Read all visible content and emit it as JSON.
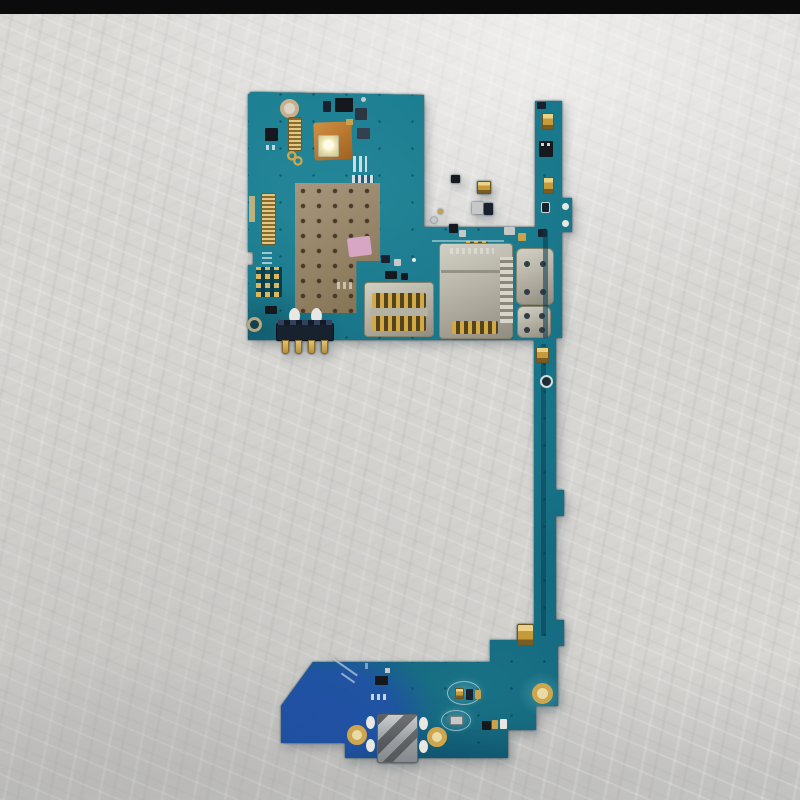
{
  "scene": {
    "description": "Photograph of a bare smartphone motherboard (logic board) with attached charging sub-board, lying on a crinkled light-gray surface",
    "background": "crinkled white-gray plastic sheet",
    "top_edge": "black horizontal bar across top of photo",
    "object": "teal phone PCB: main board (top left), narrow interconnect strip (right), charging-port sub-board (bottom)"
  },
  "palette": {
    "bg_base": "#d7d6d3",
    "top_bar": "#0b0b0b",
    "pcb": "#15758a",
    "pcb_deep": "#083b4c",
    "pcb_blue": "#2252aa",
    "gold": "#c9a24b",
    "silver": "#c7c9c9",
    "metal": "#b3b6b8",
    "navy": "#18222f",
    "ink": "#15191d",
    "white_pad": "#e9e7e2",
    "silk": "#dfe8ea",
    "shield_tan": "#9c8a6e",
    "sticker_pink": "#d7a6c4",
    "copper_flex": "#c07c30",
    "led_white": "#f7f2dc",
    "hole_tan": "#c9b08a"
  },
  "parts": [
    {
      "name": "screw-hole-top-left",
      "kind": "hole",
      "x": 280,
      "y": 99,
      "w": 19,
      "h": 19,
      "border": "4px solid #c9b08a",
      "fill": "#d8d4c8"
    },
    {
      "name": "fpc-connector-top-left",
      "kind": "ridged-h",
      "x": 288,
      "y": 117,
      "w": 14,
      "h": 34,
      "rr": 2,
      "border": "1px solid #6b5a28"
    },
    {
      "name": "ic-chip-a",
      "x": 265,
      "y": 128,
      "w": 13,
      "h": 13,
      "fill": "ink",
      "rr": 1
    },
    {
      "name": "pad-dots-a",
      "kind": "stripes-white",
      "x": 266,
      "y": 145,
      "w": 12,
      "h": 5,
      "op": 0.8
    },
    {
      "name": "antenna-squiggle",
      "kind": "squiggle",
      "x": 286,
      "y": 150,
      "w": 18,
      "h": 16
    },
    {
      "name": "flex-pad-orange",
      "kind": "copper",
      "x": 314,
      "y": 122,
      "w": 38,
      "h": 38,
      "rr": 3,
      "rot": -2
    },
    {
      "name": "led-flash",
      "kind": "led",
      "x": 318,
      "y": 135,
      "w": 21,
      "h": 22
    },
    {
      "name": "ic-chip-b",
      "x": 335,
      "y": 98,
      "w": 18,
      "h": 14,
      "fill": "ink",
      "rr": 1
    },
    {
      "name": "ic-chip-b2",
      "x": 323,
      "y": 101,
      "w": 8,
      "h": 11,
      "fill": "navy",
      "rr": 1
    },
    {
      "name": "ic-chip-c",
      "x": 355,
      "y": 108,
      "w": 12,
      "h": 12,
      "fill": "#2c3540",
      "rr": 1
    },
    {
      "name": "ic-chip-d",
      "x": 357,
      "y": 128,
      "w": 13,
      "h": 11,
      "fill": "#35404e",
      "rr": 1
    },
    {
      "name": "dot-silver-a",
      "kind": "dot",
      "x": 361,
      "y": 97,
      "w": 5,
      "h": 5,
      "fill": "silver"
    },
    {
      "name": "chip-gold-tiny-a",
      "x": 346,
      "y": 119,
      "w": 7,
      "h": 6,
      "fill": "gold"
    },
    {
      "name": "pad-row-a",
      "kind": "stripes-white",
      "x": 353,
      "y": 156,
      "w": 14,
      "h": 16,
      "op": 0.85
    },
    {
      "name": "pad-row-b",
      "kind": "stripes-blue",
      "x": 352,
      "y": 175,
      "w": 22,
      "h": 8
    },
    {
      "name": "pad-row-c",
      "kind": "stripes-white",
      "x": 344,
      "y": 186,
      "w": 18,
      "h": 6,
      "op": 0.7
    },
    {
      "name": "edge-pad-gold",
      "x": 249,
      "y": 196,
      "w": 6,
      "h": 26,
      "fill": "#cdb77c",
      "op": 0.9
    },
    {
      "name": "fpc-connector-left",
      "kind": "ridged-h",
      "x": 261,
      "y": 193,
      "w": 15,
      "h": 52,
      "rr": 2,
      "border": "1px solid #6b5a28"
    },
    {
      "name": "silk-dashes-a",
      "kind": "stripes-white-h",
      "x": 262,
      "y": 251,
      "w": 10,
      "h": 18,
      "op": 0.7
    },
    {
      "name": "test-pad-grid",
      "kind": "grid-pads",
      "x": 256,
      "y": 267,
      "w": 26,
      "h": 30
    },
    {
      "name": "ic-chip-f",
      "x": 265,
      "y": 306,
      "w": 12,
      "h": 8,
      "fill": "ink",
      "rr": 1
    },
    {
      "name": "screw-hole-bottom-left",
      "kind": "hole",
      "x": 247,
      "y": 317,
      "w": 15,
      "h": 15,
      "border": "3px solid #b9a87e",
      "fill": "#12404e"
    },
    {
      "name": "rf-shield",
      "kind": "shield",
      "x": 295,
      "y": 183,
      "w": 85,
      "h": 130
    },
    {
      "name": "sticker-pink",
      "x": 348,
      "y": 237,
      "w": 23,
      "h": 19,
      "fill": "sticker_pink",
      "rr": 2,
      "rot": -7
    },
    {
      "name": "ic-chip-g",
      "x": 451,
      "y": 175,
      "w": 9,
      "h": 8,
      "fill": "ink",
      "rr": 1
    },
    {
      "name": "chip-gold-a",
      "kind": "chip-gold",
      "x": 477,
      "y": 181,
      "w": 14,
      "h": 13,
      "rr": 1
    },
    {
      "name": "chip-silver-b",
      "x": 472,
      "y": 202,
      "w": 11,
      "h": 12,
      "fill": "silver",
      "rr": 1
    },
    {
      "name": "chip-navy-a",
      "x": 484,
      "y": 203,
      "w": 9,
      "h": 12,
      "fill": "navy",
      "rr": 1
    },
    {
      "name": "ic-chip-h",
      "x": 449,
      "y": 224,
      "w": 9,
      "h": 9,
      "fill": "ink",
      "rr": 1
    },
    {
      "name": "chip-silver-c",
      "x": 459,
      "y": 230,
      "w": 7,
      "h": 7,
      "fill": "silver",
      "rr": 1
    },
    {
      "name": "pad-row-d",
      "kind": "ridged-v-gold",
      "x": 466,
      "y": 241,
      "w": 22,
      "h": 9
    },
    {
      "name": "dot-silver-b",
      "kind": "dot",
      "x": 431,
      "y": 217,
      "w": 6,
      "h": 6,
      "fill": "silver"
    },
    {
      "name": "dot-gold-a",
      "kind": "dot",
      "x": 438,
      "y": 209,
      "w": 5,
      "h": 5,
      "fill": "gold"
    },
    {
      "name": "chip-silver-d",
      "x": 504,
      "y": 227,
      "w": 11,
      "h": 8,
      "fill": "silver",
      "rr": 1
    },
    {
      "name": "chip-gold-b",
      "x": 518,
      "y": 233,
      "w": 8,
      "h": 8,
      "fill": "gold",
      "rr": 1
    },
    {
      "name": "chip-navy-b",
      "x": 538,
      "y": 229,
      "w": 9,
      "h": 8,
      "fill": "navy",
      "rr": 1
    },
    {
      "name": "silk-line-a",
      "x": 432,
      "y": 240,
      "w": 72,
      "h": 2,
      "fill": "silk",
      "op": 0.5
    },
    {
      "name": "ic-chip-i",
      "x": 385,
      "y": 271,
      "w": 12,
      "h": 8,
      "fill": "ink",
      "rr": 1
    },
    {
      "name": "ic-chip-j",
      "x": 401,
      "y": 273,
      "w": 7,
      "h": 7,
      "fill": "ink",
      "rr": 1
    },
    {
      "name": "silk-dashes-b",
      "kind": "stripes-white",
      "x": 337,
      "y": 282,
      "w": 16,
      "h": 7,
      "op": 0.6
    },
    {
      "name": "chip-navy-c",
      "x": 381,
      "y": 255,
      "w": 9,
      "h": 8,
      "fill": "navy",
      "rr": 1
    },
    {
      "name": "chip-silver-e",
      "x": 394,
      "y": 259,
      "w": 7,
      "h": 7,
      "fill": "silver",
      "rr": 1
    },
    {
      "name": "dot-white-a",
      "kind": "dot",
      "x": 412,
      "y": 258,
      "w": 4,
      "h": 4,
      "fill": "white_pad"
    },
    {
      "name": "sim-reader-base",
      "kind": "metal",
      "x": 364,
      "y": 282,
      "w": 70,
      "h": 55,
      "rr": 4
    },
    {
      "name": "sim-contacts-top",
      "kind": "ridged-v-gold",
      "x": 372,
      "y": 293,
      "w": 54,
      "h": 15,
      "rr": 2
    },
    {
      "name": "sim-bridge",
      "x": 370,
      "y": 308,
      "w": 58,
      "h": 8,
      "fill": "#b5b2a4"
    },
    {
      "name": "sim-contacts-bottom",
      "kind": "ridged-v-gold",
      "x": 372,
      "y": 316,
      "w": 54,
      "h": 15,
      "rr": 2
    },
    {
      "name": "sd-reader-base",
      "kind": "metal",
      "x": 439,
      "y": 243,
      "w": 74,
      "h": 96,
      "rr": 4
    },
    {
      "name": "sd-engraving",
      "kind": "stripes-white",
      "x": 450,
      "y": 248,
      "w": 44,
      "h": 6,
      "op": 0.4
    },
    {
      "name": "sd-slot-line",
      "x": 441,
      "y": 270,
      "w": 70,
      "h": 3,
      "fill": "#8d897c",
      "op": 0.85
    },
    {
      "name": "sd-teeth",
      "kind": "teeth",
      "x": 500,
      "y": 257,
      "w": 13,
      "h": 66
    },
    {
      "name": "sd-contact-pads",
      "kind": "ridged-v-gold",
      "x": 452,
      "y": 321,
      "w": 46,
      "h": 13,
      "rr": 2
    },
    {
      "name": "shield-can-a",
      "kind": "metal",
      "x": 516,
      "y": 248,
      "w": 38,
      "h": 57,
      "rr": 6
    },
    {
      "name": "can-a-dot-1",
      "kind": "dot",
      "x": 524,
      "y": 261,
      "w": 6,
      "h": 6,
      "fill": "#323c44"
    },
    {
      "name": "can-a-dot-2",
      "kind": "dot",
      "x": 540,
      "y": 261,
      "w": 6,
      "h": 6,
      "fill": "#323c44"
    },
    {
      "name": "can-a-dot-3",
      "kind": "dot",
      "x": 524,
      "y": 289,
      "w": 6,
      "h": 6,
      "fill": "#323c44"
    },
    {
      "name": "can-a-dot-4",
      "kind": "dot",
      "x": 540,
      "y": 289,
      "w": 6,
      "h": 6,
      "fill": "#323c44"
    },
    {
      "name": "shield-can-b",
      "kind": "metal",
      "x": 517,
      "y": 306,
      "w": 34,
      "h": 32,
      "rr": 6
    },
    {
      "name": "can-b-dot-1",
      "kind": "dot",
      "x": 524,
      "y": 313,
      "w": 6,
      "h": 6,
      "fill": "#323c44"
    },
    {
      "name": "can-b-dot-2",
      "kind": "dot",
      "x": 539,
      "y": 313,
      "w": 6,
      "h": 6,
      "fill": "#323c44"
    },
    {
      "name": "can-b-dot-3",
      "kind": "dot",
      "x": 524,
      "y": 327,
      "w": 6,
      "h": 6,
      "fill": "#323c44"
    },
    {
      "name": "can-b-dot-4",
      "kind": "dot",
      "x": 539,
      "y": 327,
      "w": 6,
      "h": 6,
      "fill": "#323c44"
    },
    {
      "name": "solder-oval-a",
      "kind": "dot",
      "x": 289,
      "y": 308,
      "w": 11,
      "h": 16,
      "fill": "white_pad"
    },
    {
      "name": "solder-oval-b",
      "kind": "dot",
      "x": 311,
      "y": 308,
      "w": 11,
      "h": 16,
      "fill": "white_pad"
    },
    {
      "name": "battery-connector",
      "x": 276,
      "y": 323,
      "w": 58,
      "h": 18,
      "fill": "navy",
      "rr": 2,
      "border": "1px solid #0c1220"
    },
    {
      "name": "battery-connector-teeth",
      "kind": "batt-teeth",
      "x": 278,
      "y": 320,
      "w": 54,
      "h": 5
    },
    {
      "name": "battery-pin-1",
      "kind": "pin",
      "x": 282,
      "y": 340,
      "w": 7,
      "h": 14
    },
    {
      "name": "battery-pin-2",
      "kind": "pin",
      "x": 295,
      "y": 340,
      "w": 7,
      "h": 14
    },
    {
      "name": "battery-pin-3",
      "kind": "pin",
      "x": 308,
      "y": 340,
      "w": 7,
      "h": 14
    },
    {
      "name": "battery-pin-4",
      "kind": "pin",
      "x": 321,
      "y": 340,
      "w": 7,
      "h": 14
    },
    {
      "name": "strip-tip-chip",
      "x": 537,
      "y": 102,
      "w": 9,
      "h": 7,
      "fill": "navy",
      "rr": 1
    },
    {
      "name": "strip-gold-a",
      "kind": "chip-gold",
      "x": 542,
      "y": 113,
      "w": 12,
      "h": 17,
      "rr": 1
    },
    {
      "name": "strip-ic",
      "x": 539,
      "y": 141,
      "w": 14,
      "h": 16,
      "fill": "ink",
      "rr": 1
    },
    {
      "name": "strip-ic-dots",
      "kind": "stripes-white",
      "x": 541,
      "y": 143,
      "w": 9,
      "h": 3,
      "op": 0.9
    },
    {
      "name": "strip-gold-b",
      "kind": "chip-gold",
      "x": 543,
      "y": 177,
      "w": 11,
      "h": 17,
      "rr": 1
    },
    {
      "name": "strip-chip-dark",
      "x": 541,
      "y": 202,
      "w": 9,
      "h": 11,
      "fill": "navy",
      "rr": 2,
      "border": "1px solid #cfd6d2"
    },
    {
      "name": "tab-hole-a",
      "kind": "dot",
      "x": 562,
      "y": 203,
      "w": 7,
      "h": 7,
      "fill": "white_pad"
    },
    {
      "name": "tab-hole-b",
      "kind": "dot",
      "x": 562,
      "y": 220,
      "w": 7,
      "h": 7,
      "fill": "white_pad"
    },
    {
      "name": "strip-trace-upper",
      "x": 543,
      "y": 230,
      "w": 5,
      "h": 108,
      "fill": "pcb_deep",
      "op": 0.55
    },
    {
      "name": "strip-trace-lower",
      "x": 541,
      "y": 344,
      "w": 5,
      "h": 292,
      "fill": "pcb_deep",
      "op": 0.5
    },
    {
      "name": "strip-gold-c",
      "kind": "chip-gold",
      "x": 536,
      "y": 347,
      "w": 13,
      "h": 16,
      "rr": 1
    },
    {
      "name": "strip-ring-component",
      "kind": "hole",
      "x": 540,
      "y": 375,
      "w": 13,
      "h": 13,
      "border": "2px solid #d6dcd8",
      "fill": "#1d2d36"
    },
    {
      "name": "bb-gold-pad",
      "kind": "chip-gold",
      "x": 517,
      "y": 624,
      "w": 17,
      "h": 22,
      "rr": 2
    },
    {
      "name": "halo-a",
      "kind": "halo",
      "x": 518,
      "y": 672,
      "w": 48,
      "h": 44
    },
    {
      "name": "bb-gold-ring",
      "kind": "ring-gold",
      "x": 532,
      "y": 683,
      "w": 21,
      "h": 21
    },
    {
      "name": "bb-ic-a",
      "x": 375,
      "y": 676,
      "w": 13,
      "h": 9,
      "fill": "ink",
      "rr": 1
    },
    {
      "name": "bb-chip-tiny",
      "x": 385,
      "y": 668,
      "w": 5,
      "h": 5,
      "fill": "silver"
    },
    {
      "name": "bb-pad-row",
      "kind": "stripes-white",
      "x": 371,
      "y": 694,
      "w": 17,
      "h": 6,
      "op": 0.85
    },
    {
      "name": "bb-silk-diag-a",
      "x": 330,
      "y": 666,
      "w": 30,
      "h": 2,
      "fill": "silk",
      "op": 0.6,
      "rot": 35
    },
    {
      "name": "bb-silk-diag-b",
      "x": 340,
      "y": 677,
      "w": 16,
      "h": 2,
      "fill": "silk",
      "op": 0.6,
      "rot": 35
    },
    {
      "name": "bb-silk-tick",
      "x": 365,
      "y": 663,
      "w": 3,
      "h": 6,
      "fill": "silk",
      "op": 0.5
    },
    {
      "name": "halo-b",
      "kind": "halo",
      "x": 443,
      "y": 676,
      "w": 44,
      "h": 32
    },
    {
      "name": "halo-c",
      "kind": "halo",
      "x": 436,
      "y": 704,
      "w": 40,
      "h": 30
    },
    {
      "name": "bb-oval-outline-a",
      "kind": "oval-outline",
      "x": 447,
      "y": 681,
      "w": 34,
      "h": 24
    },
    {
      "name": "bb-oval-outline-b",
      "kind": "oval-outline",
      "x": 441,
      "y": 710,
      "w": 30,
      "h": 21
    },
    {
      "name": "bb-gold-chip-a",
      "kind": "chip-gold",
      "x": 455,
      "y": 688,
      "w": 9,
      "h": 11
    },
    {
      "name": "bb-navy-chip",
      "x": 466,
      "y": 689,
      "w": 7,
      "h": 11,
      "fill": "navy",
      "rr": 1
    },
    {
      "name": "bb-gold-chip-b",
      "x": 475,
      "y": 690,
      "w": 6,
      "h": 9,
      "fill": "gold",
      "rr": 1
    },
    {
      "name": "bb-silver-comp",
      "x": 450,
      "y": 716,
      "w": 13,
      "h": 9,
      "fill": "silver",
      "rr": 1,
      "border": "1px solid #7a8084"
    },
    {
      "name": "bb-dark-square",
      "x": 482,
      "y": 721,
      "w": 9,
      "h": 9,
      "fill": "ink",
      "rr": 1
    },
    {
      "name": "bb-gold-pair-a",
      "x": 492,
      "y": 720,
      "w": 6,
      "h": 9,
      "fill": "gold",
      "rr": 1
    },
    {
      "name": "bb-pale-pair-b",
      "x": 500,
      "y": 719,
      "w": 7,
      "h": 10,
      "fill": "white_pad",
      "rr": 1
    },
    {
      "name": "usb-solder-oval-a",
      "kind": "dot",
      "x": 366,
      "y": 716,
      "w": 9,
      "h": 13,
      "fill": "white_pad"
    },
    {
      "name": "usb-solder-oval-b",
      "kind": "dot",
      "x": 366,
      "y": 739,
      "w": 9,
      "h": 13,
      "fill": "white_pad"
    },
    {
      "name": "usb-solder-oval-c",
      "kind": "dot",
      "x": 419,
      "y": 717,
      "w": 9,
      "h": 13,
      "fill": "white_pad"
    },
    {
      "name": "usb-solder-oval-d",
      "kind": "dot",
      "x": 419,
      "y": 740,
      "w": 9,
      "h": 13,
      "fill": "white_pad"
    },
    {
      "name": "usb-gold-ring-left",
      "kind": "ring-gold",
      "x": 347,
      "y": 725,
      "w": 20,
      "h": 20
    },
    {
      "name": "usb-gold-ring-right",
      "kind": "ring-gold",
      "x": 427,
      "y": 727,
      "w": 20,
      "h": 20
    },
    {
      "name": "usb-connector",
      "kind": "usb",
      "x": 377,
      "y": 714,
      "w": 41,
      "h": 49,
      "rr": 3
    }
  ]
}
